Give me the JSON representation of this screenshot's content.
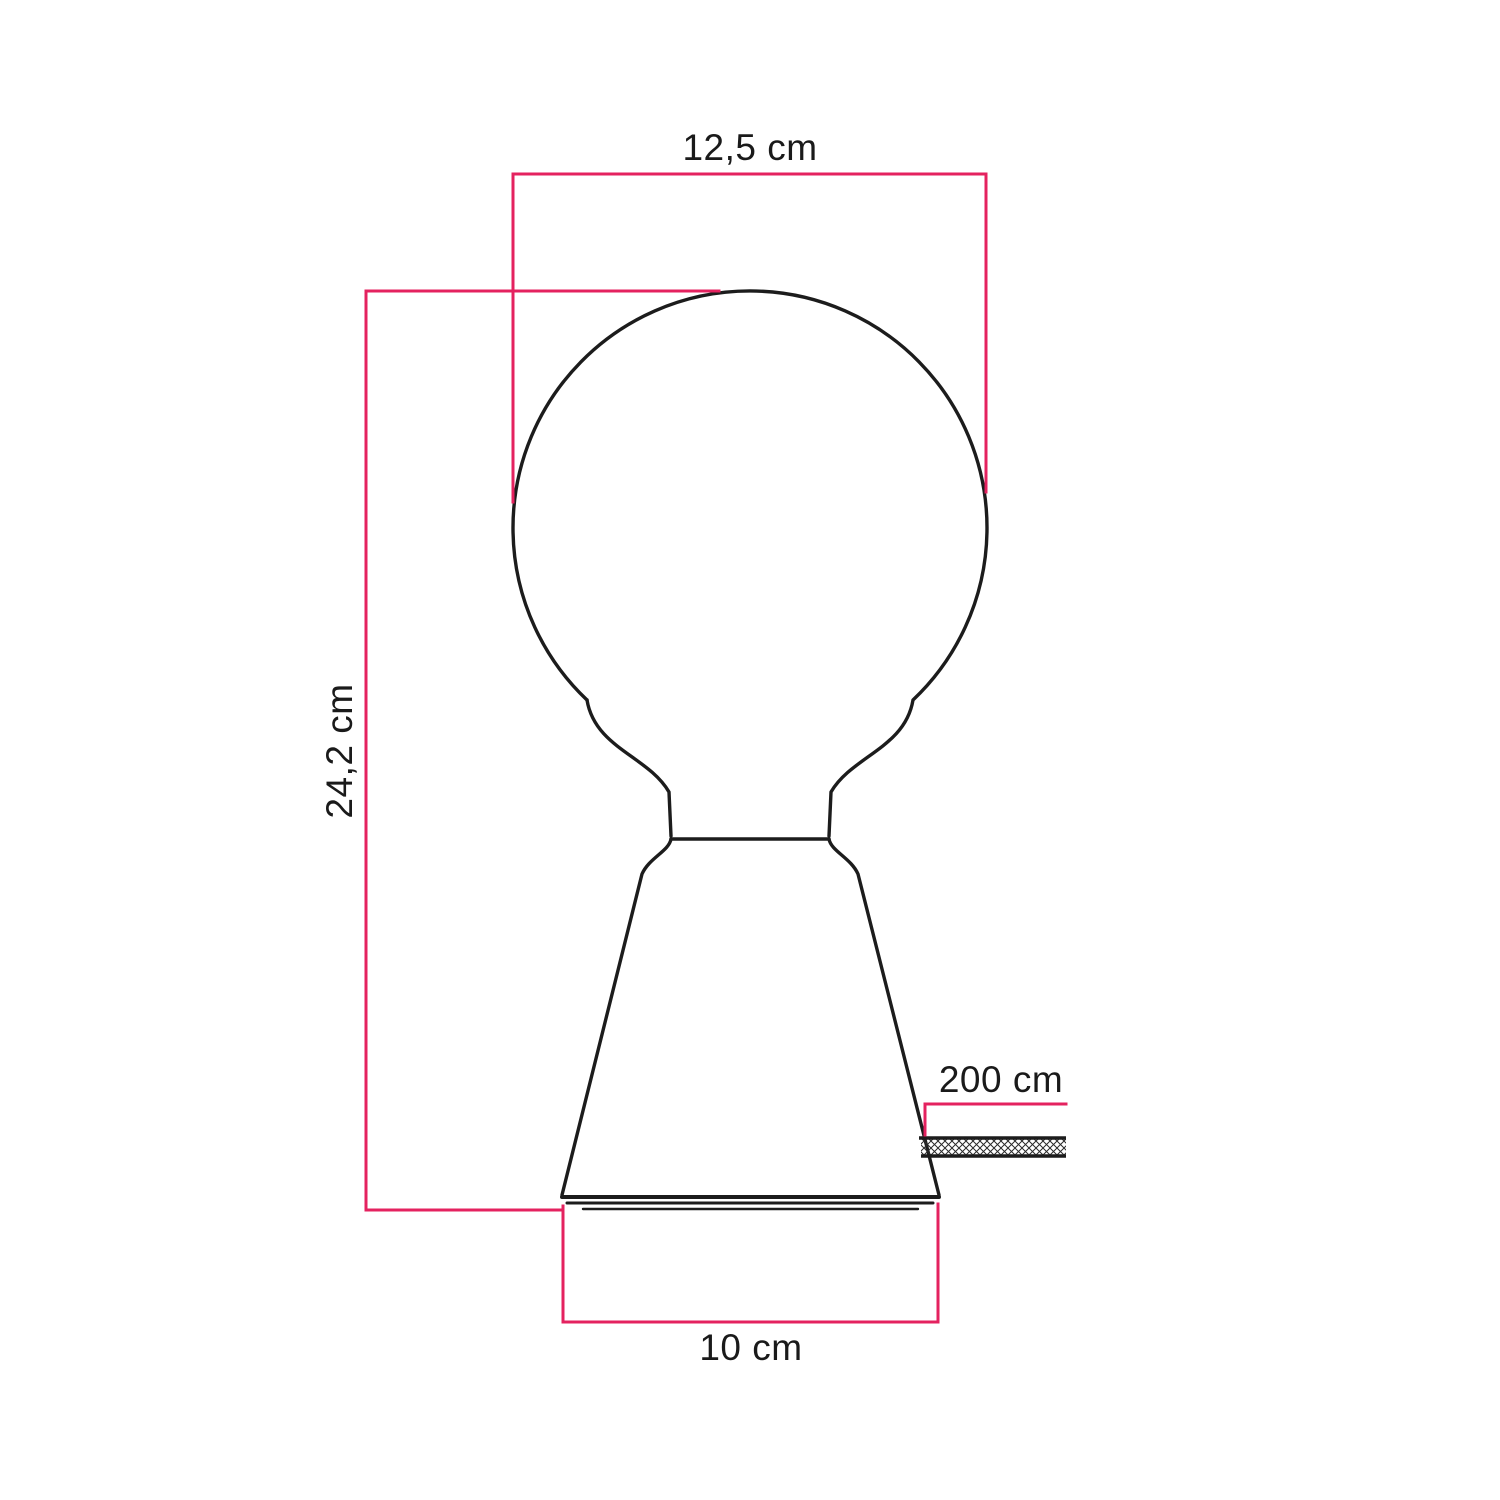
{
  "diagram": {
    "title": "table-lamp-dimension-drawing",
    "labels": {
      "bulb_diameter": "12,5 cm",
      "total_height": "24,2 cm",
      "cable_length": "200 cm",
      "base_width": "10 cm"
    },
    "colors": {
      "dimension": "#e4225f",
      "outline": "#1c1c1c",
      "text": "#1a1a1a",
      "background": "#ffffff"
    }
  }
}
